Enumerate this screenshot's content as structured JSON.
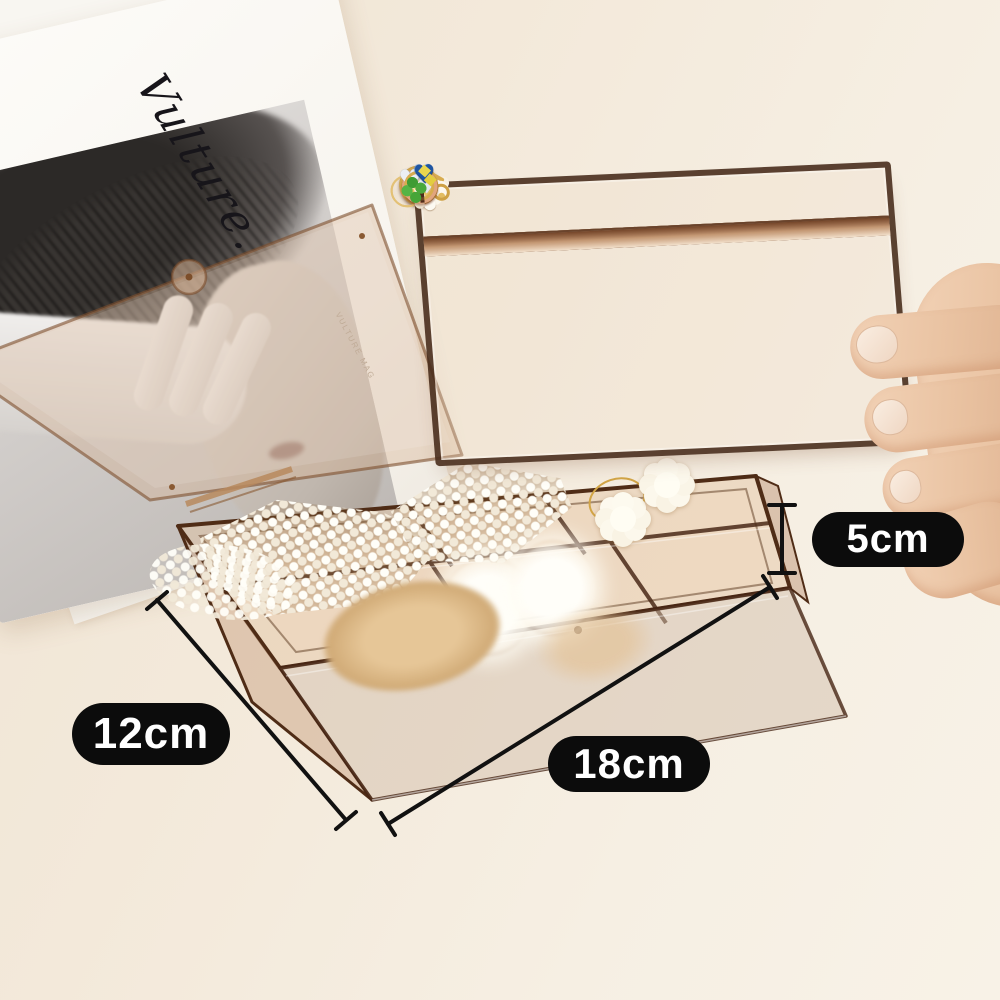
{
  "annotations": {
    "height": {
      "label": "5cm"
    },
    "width": {
      "label": "12cm"
    },
    "length": {
      "label": "18cm"
    },
    "pill_bg": "#0c0c0c",
    "pill_text": "#ffffff",
    "line_color": "#111111"
  },
  "magazine": {
    "title": "Vulture.",
    "caption": "VULTURE MAG"
  },
  "tray": {
    "rows": 4,
    "cols": 6,
    "cells": [
      {
        "name": "striped-ball-earring",
        "icon": "striped"
      },
      {
        "name": "striped-ball-earring",
        "icon": "striped"
      },
      {
        "name": "red-cube-earring",
        "icon": "redsq"
      },
      {
        "name": "red-cube-earring",
        "icon": "redsq"
      },
      {
        "name": "gold-hoop-earrings",
        "icon": "hoops"
      },
      {
        "name": "gold-hoop-earring",
        "icon": "hoops"
      },
      {
        "name": "pearl-strand-earrings",
        "icon": "pearls"
      },
      {
        "name": "pearl-cluster-gold-pin-earring",
        "icon": "pearlgold"
      },
      {
        "name": "pearl-stud-earrings",
        "icon": "studs"
      },
      {
        "name": "gold-pearl-studs",
        "icon": "goldstuds"
      },
      {
        "name": "gold-wire-ball-earring",
        "icon": "wireball"
      },
      {
        "name": "gold-wire-ball-earring",
        "icon": "wireball"
      },
      {
        "name": "rose-gold-ring",
        "icon": "rosering"
      },
      {
        "name": "rose-gold-ring",
        "icon": "rosering"
      },
      {
        "name": "silver-star-earring",
        "icon": "star"
      },
      {
        "name": "silver-star-earring",
        "icon": "star"
      },
      {
        "name": "gold-pearl-dangle-earring",
        "icon": "dangle"
      },
      {
        "name": "gold-flower-earring",
        "icon": "flowergold"
      },
      {
        "name": "rose-gold-ring",
        "icon": "rosering"
      },
      {
        "name": "rose-gold-ring",
        "icon": "rosering"
      },
      {
        "name": "silver-heart-earrings",
        "icon": "hearts"
      },
      {
        "name": "blue-heart-gem-ring",
        "icon": "bluegem"
      },
      {
        "name": "clover-bow-earring",
        "icon": "clover"
      },
      {
        "name": "clover-bow-earring",
        "icon": "clover"
      }
    ]
  },
  "box": {
    "items": [
      {
        "name": "pearl-triangle-hairclip-large",
        "icon": "pearlclip-a"
      },
      {
        "name": "pearl-triangle-hairclip-small",
        "icon": "pearlclip-b"
      },
      {
        "name": "white-flower-hair-ties",
        "icon": "flowers"
      },
      {
        "name": "white-pompom-hair-ties",
        "icon": "pompoms"
      },
      {
        "name": "tan-fur-scrunchie",
        "icon": "scrunchie"
      },
      {
        "name": "loose-pearls",
        "icon": "loosepearls"
      }
    ]
  },
  "colors": {
    "background_cream": "#f3e9da",
    "acrylic_amber": "#c89a6e",
    "acrylic_edge_brown": "#4f2c16",
    "gold": "#d8ac50",
    "rose_gold": "#e1a57e",
    "silver": "#eceff4",
    "red_accent": "#c61a1a",
    "blue_gem": "#1e55a2",
    "clover_green": "#4aa83c",
    "bow_yellow": "#ead64e",
    "skin": "#e9c2a1"
  }
}
